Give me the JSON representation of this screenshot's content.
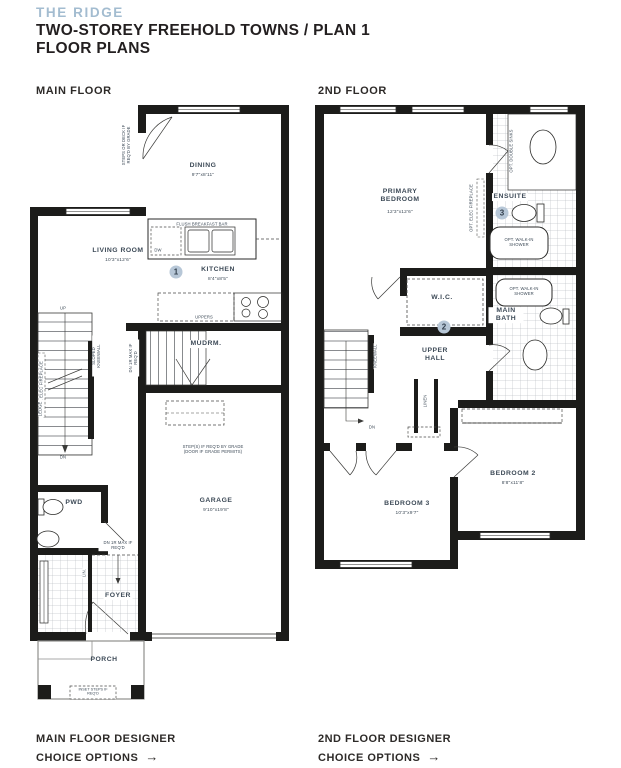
{
  "header": {
    "brand": "THE RIDGE",
    "title": "TWO-STOREY FREEHOLD TOWNS / PLAN 1",
    "subtitle": "FLOOR PLANS"
  },
  "main_floor": {
    "section_label": "MAIN FLOOR",
    "rooms": {
      "dining": {
        "name": "DINING",
        "dims": "9'7\"x8'11\""
      },
      "living_room": {
        "name": "LIVING ROOM",
        "dims": "10'3\"x12'6\""
      },
      "kitchen": {
        "name": "KITCHEN",
        "dims": "8'4\"x8'5\"",
        "marker": "1"
      },
      "mudroom": {
        "name": "MUDRM."
      },
      "garage": {
        "name": "GARAGE",
        "dims": "9'10\"x19'8\""
      },
      "powder_room": {
        "name": "PWD"
      },
      "foyer": {
        "name": "FOYER"
      },
      "porch": {
        "name": "PORCH"
      }
    },
    "notes": {
      "steps_or_deck": "STEPS OR DECK IF REQ'D BY GRADE",
      "opt_elec_fireplace": "OPT. ELEC FIREPLACE",
      "flush_breakfast_bar": "FLUSH BREAKFAST BAR",
      "dishwasher": "DW",
      "uppers": "UPPERS",
      "up": "UP",
      "dn": "DN",
      "sloped_kneewall": "SLOPED KNEEWALL",
      "ledge": "LEDGE",
      "dn_1r_max": "DN 1R MAX IF REQ'D",
      "steps_if_reqd": "STEP(S) IF REQ'D BY GRADE (DOOR IF GRADE PERMITS)",
      "linen": "LIN.",
      "inset_steps": "INSET STEPS IF REQ'D"
    },
    "footer": {
      "line1": "MAIN FLOOR DESIGNER",
      "line2": "CHOICE OPTIONS",
      "arrow": "→"
    }
  },
  "second_floor": {
    "section_label": "2ND FLOOR",
    "rooms": {
      "primary_bedroom": {
        "name": "PRIMARY BEDROOM",
        "dims": "12'3\"x12'6\""
      },
      "ensuite": {
        "name": "ENSUITE",
        "marker": "3"
      },
      "wic": {
        "name": "W.I.C.",
        "marker": "2"
      },
      "upper_hall": {
        "name": "UPPER HALL"
      },
      "main_bath": {
        "name": "MAIN BATH"
      },
      "bedroom_2": {
        "name": "BEDROOM 2",
        "dims": "8'8\"x11'8\""
      },
      "bedroom_3": {
        "name": "BEDROOM 3",
        "dims": "10'3\"x9'7\""
      }
    },
    "notes": {
      "opt_double_sinks": "OPT. DOUBLE SINKS",
      "opt_elec_fireplace": "OPT. ELEC FIREPLACE",
      "opt_walkin_shower": "OPT. WALK-IN SHOWER",
      "kneewall": "KNEEWALL",
      "linen": "LINEN",
      "dn": "DN"
    },
    "footer": {
      "line1": "2ND FLOOR DESIGNER",
      "line2": "CHOICE OPTIONS",
      "arrow": "→"
    }
  }
}
